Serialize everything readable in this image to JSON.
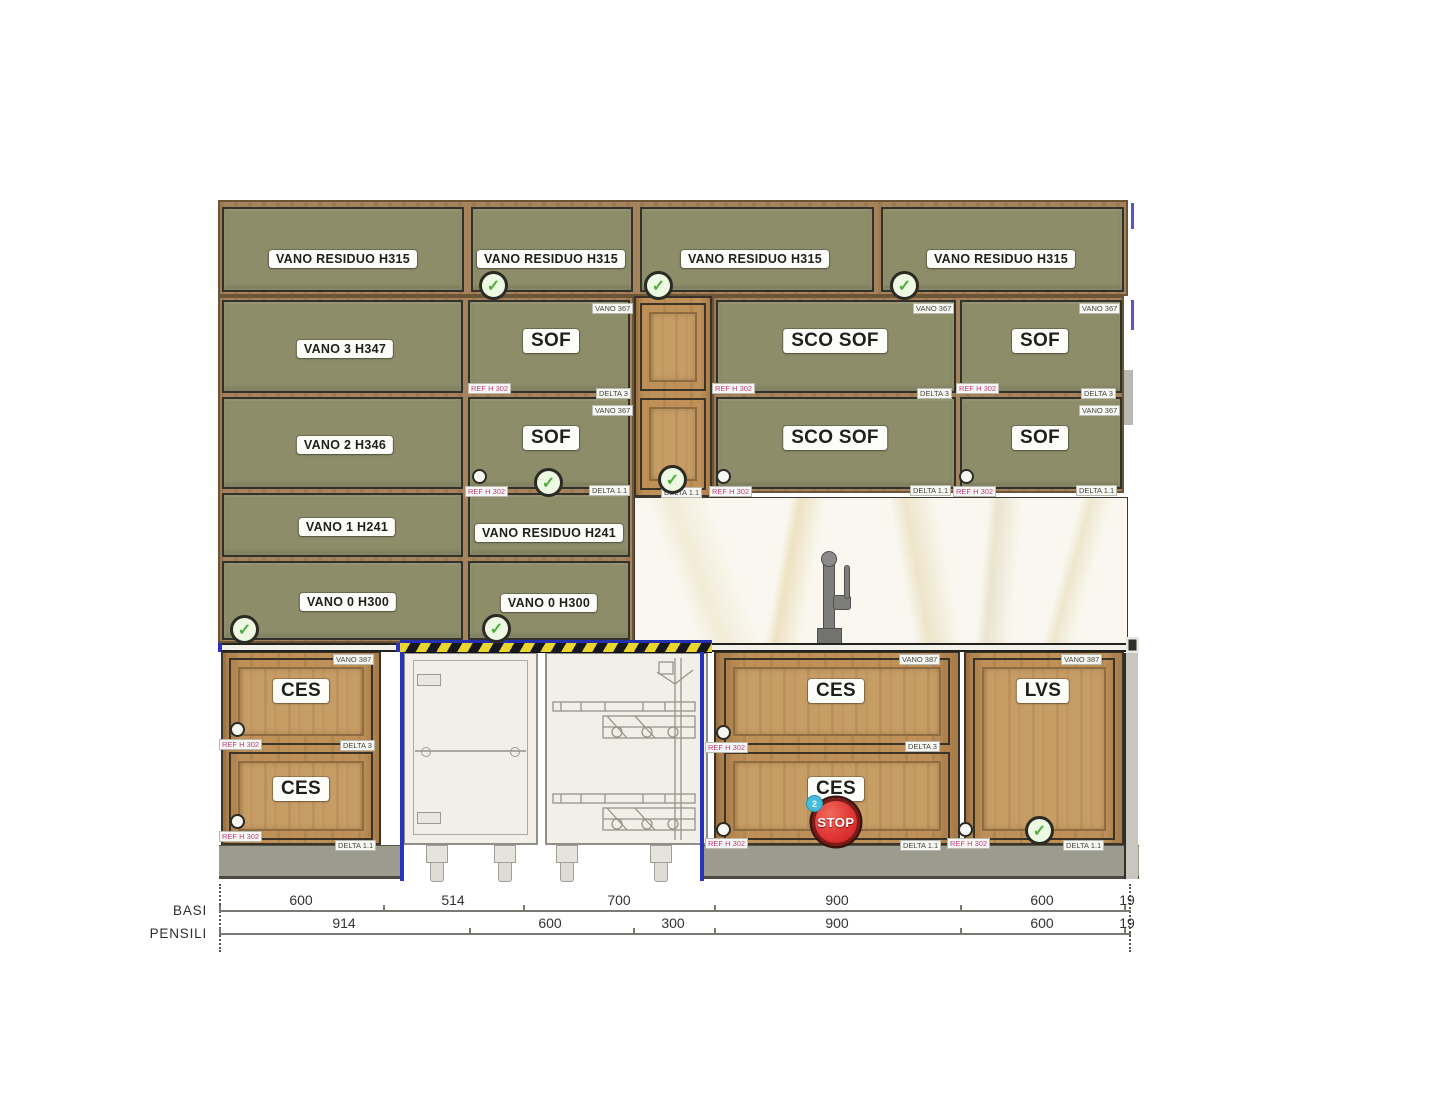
{
  "wall_units": {
    "top_row": [
      {
        "label": "VANO RESIDUO H315",
        "checked": false
      },
      {
        "label": "VANO RESIDUO H315",
        "checked": true
      },
      {
        "label": "VANO RESIDUO H315",
        "checked": true
      },
      {
        "label": "VANO RESIDUO H315",
        "checked": true
      }
    ],
    "column1": [
      "VANO 3 H347",
      "VANO 2 H346",
      "VANO 1 H241",
      "VANO 0 H300"
    ],
    "column2": [
      "SOF",
      "SOF",
      "VANO RESIDUO H241",
      "VANO 0 H300"
    ],
    "column3": [
      "SCO SOF",
      "SCO SOF"
    ],
    "column4": [
      "SOF",
      "SOF"
    ]
  },
  "base_units": {
    "left_drawers": [
      "CES",
      "CES"
    ],
    "right_drawers": [
      "CES",
      "CES"
    ],
    "lvs_door": "LVS",
    "stop_sign": "STOP",
    "stop_badge": "2"
  },
  "annotations": {
    "vano_wall": "VANO 367",
    "vano_base": "VANO 387",
    "delta_mid": "DELTA 3",
    "delta_bottom": "DELTA 1.1",
    "ref_tag": "REF H 302",
    "check_glyph": "✓"
  },
  "dimensions": {
    "rows": [
      {
        "label": "BASI",
        "values": [
          "600",
          "514",
          "700",
          "900",
          "600",
          "19"
        ]
      },
      {
        "label": "PENSILI",
        "values": [
          "914",
          "600",
          "300",
          "900",
          "600",
          "19"
        ]
      }
    ]
  },
  "colors": {
    "olive_panel": "#8d8d6a",
    "wood_frame": "#a5835c",
    "wood_front": "#bf9159",
    "plinth_gray": "#9c9c8e",
    "hazard_yellow": "#ead52f",
    "hazard_black": "#17171e",
    "accent_blue": "#2733bd",
    "stop_red": "#e23636",
    "badge_cyan": "#45bede",
    "check_green": "#4fae3d"
  }
}
